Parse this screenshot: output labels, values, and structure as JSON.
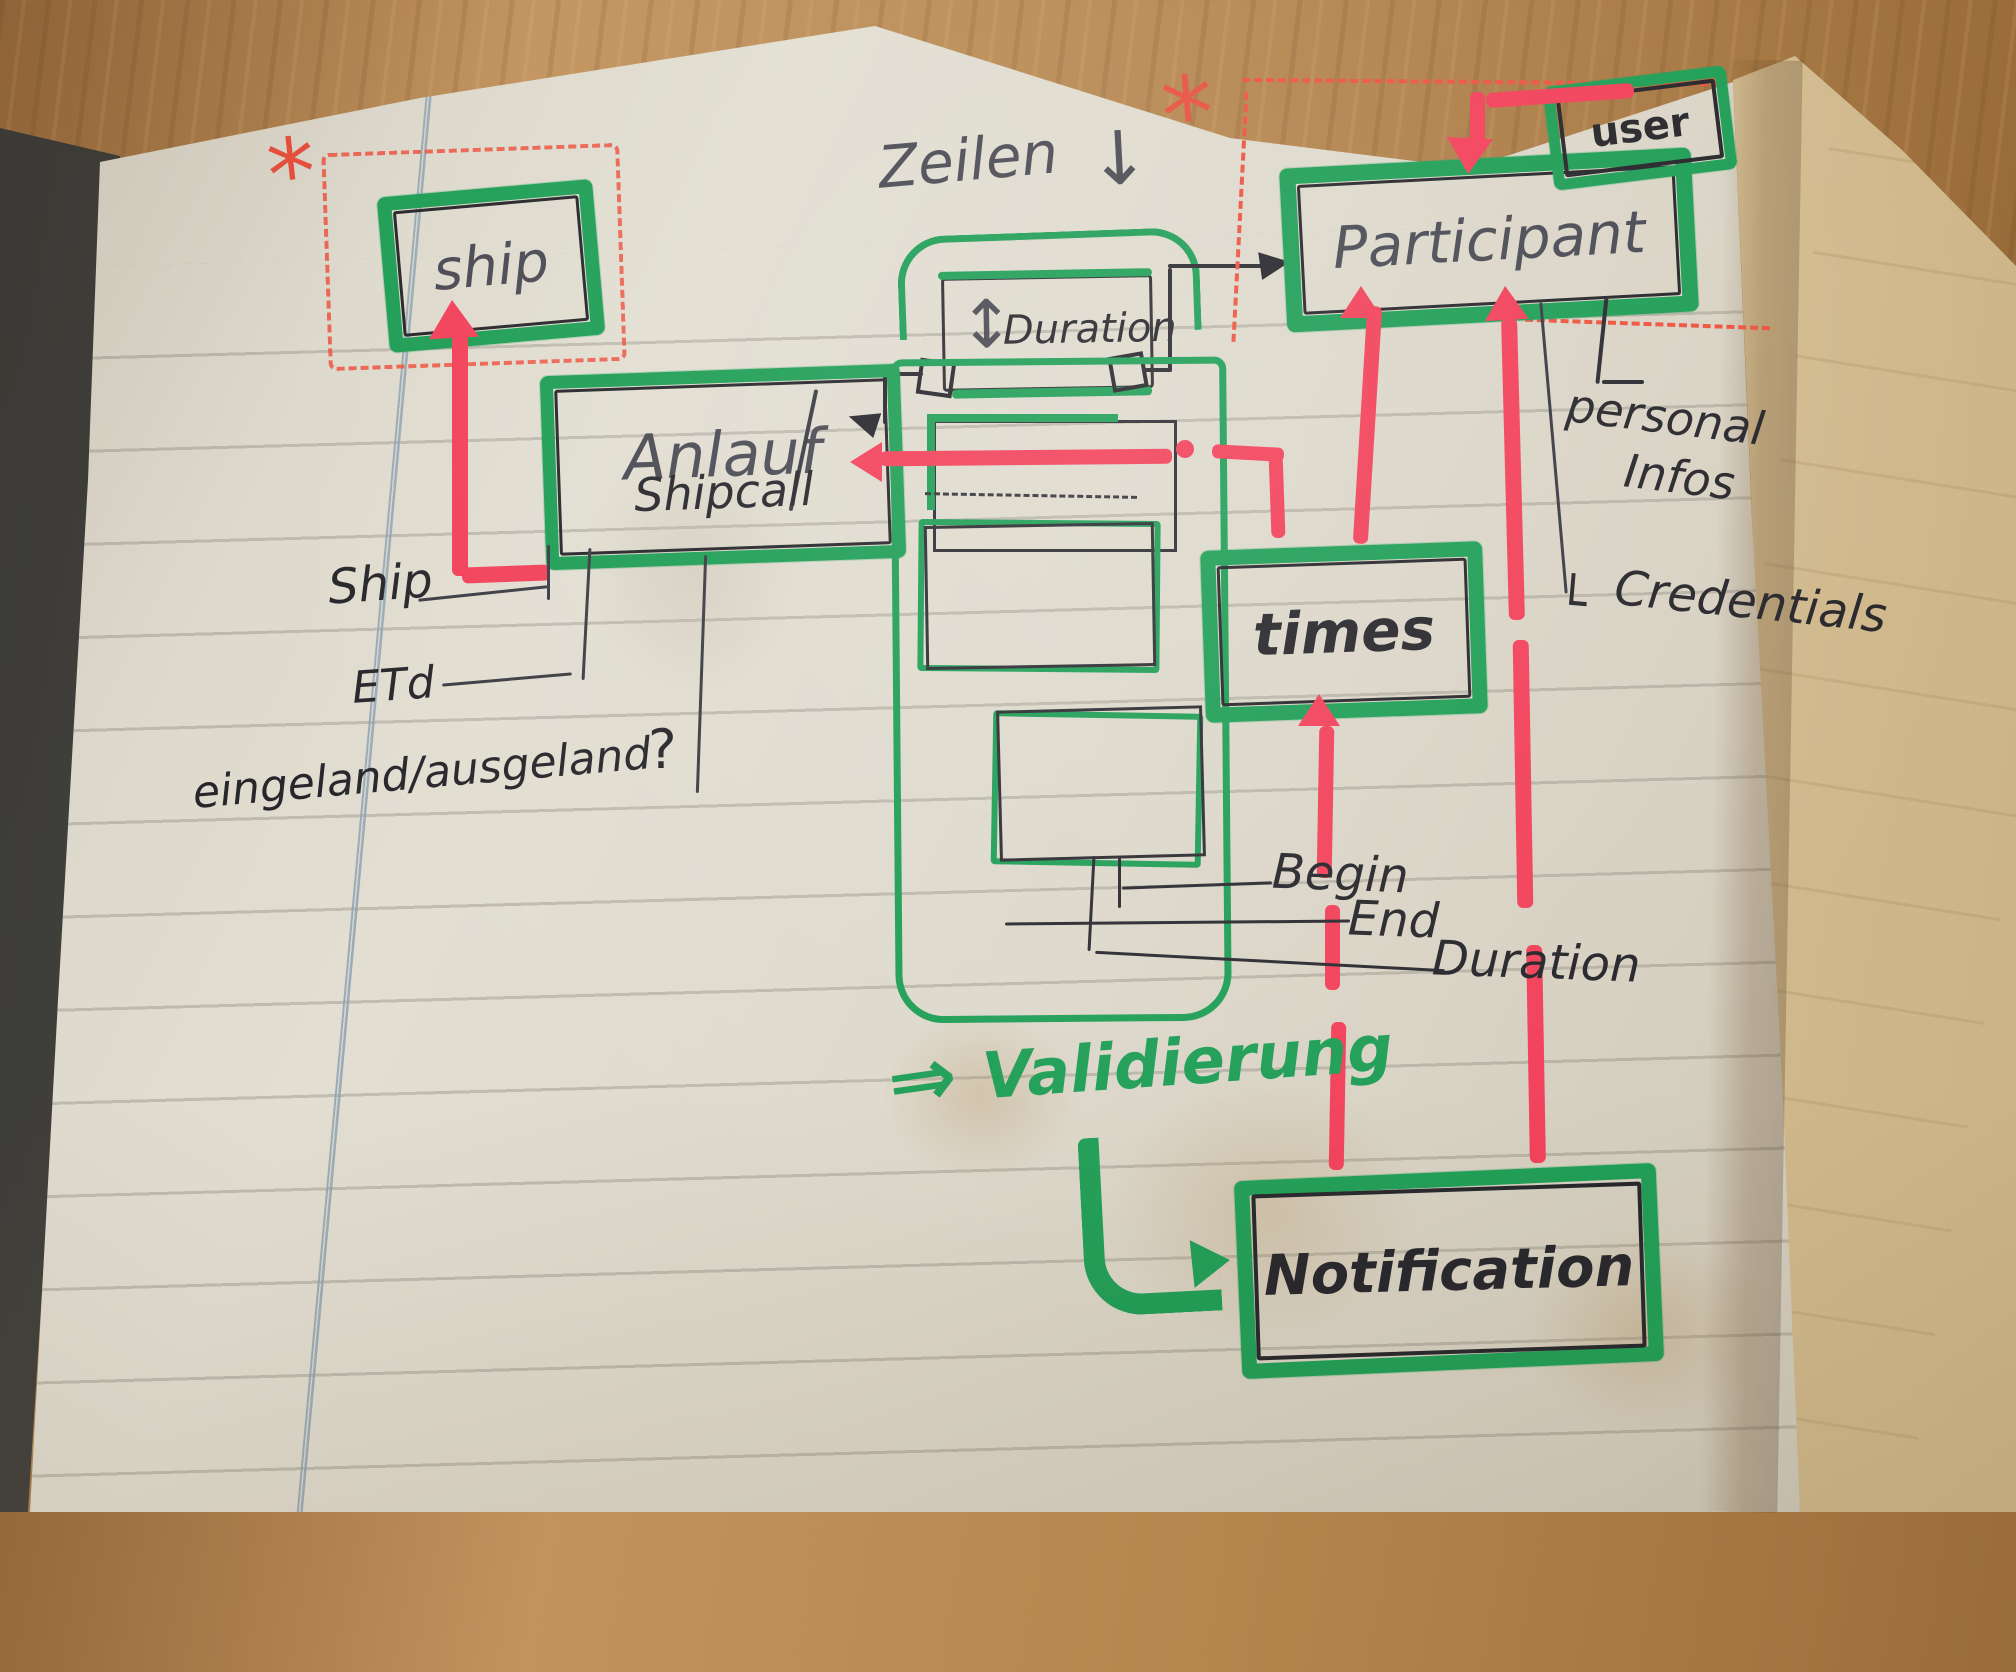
{
  "photo": {
    "type": "photo of hand-drawn data-model sketch in a notebook",
    "colors": {
      "marker_green": "#1f9e56",
      "marker_red": "#f2415a",
      "dashed_red": "#ee5340",
      "ink_black": "#26262b",
      "pencil_gray": "#4a4a54",
      "paper": "#ddd8cb",
      "back_page": "#e3d5b0",
      "wood": "#b5854e",
      "margin_blue": "#8ba0b0"
    }
  },
  "boxes": {
    "ship": {
      "label": "ship"
    },
    "anlauf": {
      "label": "Anlauf",
      "sublabel": "Shipcall"
    },
    "duration": {
      "label": "Duration",
      "arrow_glyph": "↕"
    },
    "participant": {
      "label": "Participant"
    },
    "user": {
      "label": "user"
    },
    "times": {
      "label": "times"
    },
    "notification": {
      "label": "Notification"
    }
  },
  "annotations": {
    "asterisk_left": "*",
    "asterisk_right": "*",
    "zeilen": "Zeilen",
    "zeilen_arrow": "↓",
    "ship_attr": "Ship",
    "etd": "ETd",
    "inout": "eingeland/ausgeland",
    "inout_question": "?",
    "begin": "Begin",
    "end": "End",
    "duration": "Duration",
    "personal_line1": "personal",
    "personal_line2": "Infos",
    "credentials_hook": "└",
    "credentials": "Credentials",
    "validierung_arrow": "⇒",
    "validierung": "Validierung"
  }
}
